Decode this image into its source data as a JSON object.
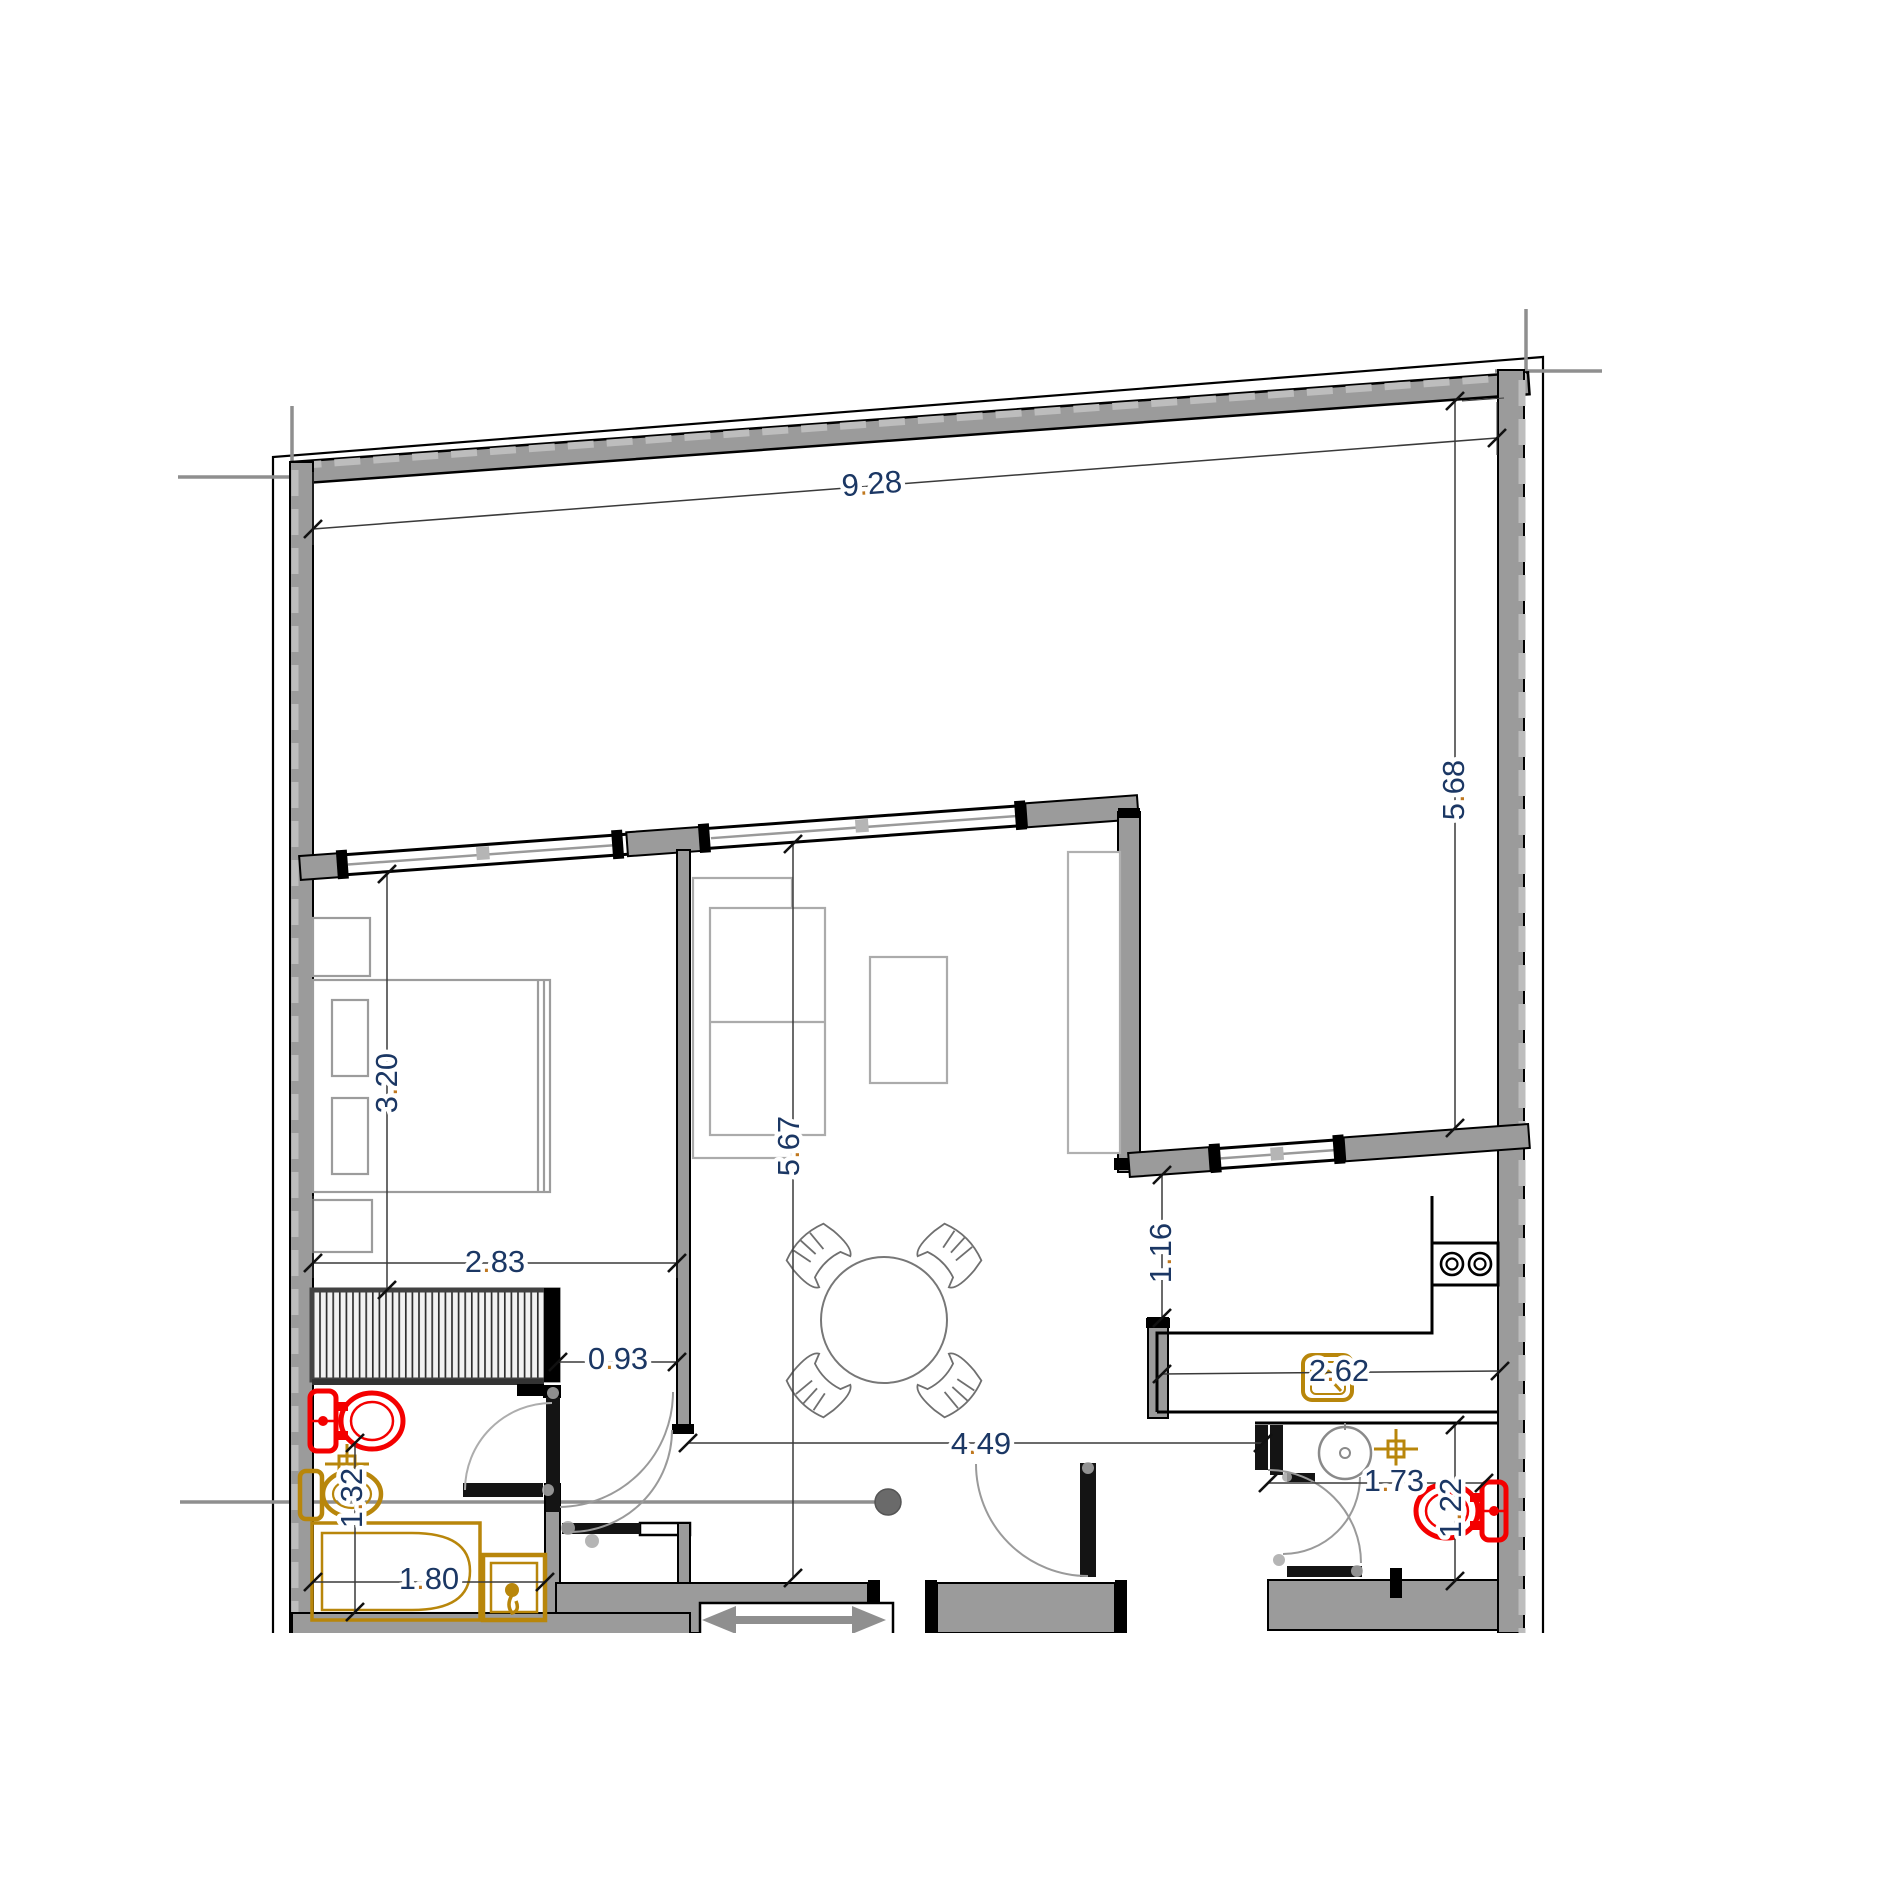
{
  "drawing": {
    "type": "architectural floor plan",
    "units_shown": "meters (implicit, no unit text rendered)"
  },
  "dims": {
    "top_width": "9.28",
    "terrace_depth": "5.68",
    "bedroom_length": "3.20",
    "bedroom_width": "2.83",
    "bedroom_door_width": "0.93",
    "living_length": "5.67",
    "hall_width": "4.49",
    "kitchen_recess": "1.16",
    "kitchen_width": "2.62",
    "bathroom_left_length": "1.32",
    "bathtub_length": "1.80",
    "bathroom_right_width": "1.73",
    "bathroom_right_length": "1.22"
  },
  "colors": {
    "wall_fill": "#9b9b9b",
    "wall_edge": "#000000",
    "dashed_centerline": "#bdbdbd",
    "dimension_text": "#1b3764",
    "dimension_decimal_dot": "#c0781f",
    "fixture_red": "#f40000",
    "fixture_gold": "#b8860b",
    "furniture_outline": "#ababab",
    "door_arc": "#9a9a9a",
    "section_marker": "#6a6a6a"
  },
  "fixtures": {
    "bed": "double bed with pillows and nightstands",
    "wardrobe": "hatched wardrobe",
    "sofa": "two-seat sofa",
    "coffee_table": "coffee table",
    "tv_cabinet": "tall cabinet",
    "dining_set": "round table with four chairs",
    "cooktop": "two-burner cooktop",
    "kitchen_sink": "kitchen sink",
    "toilet_left": "toilet (red)",
    "bidet_left": "bidet (gold)",
    "bathtub": "bathtub (gold)",
    "shower_unit": "washbasin unit (gold)",
    "washbasin_right": "round washbasin",
    "toilet_right": "toilet (red)",
    "stair_arrow": "stair direction arrow"
  }
}
